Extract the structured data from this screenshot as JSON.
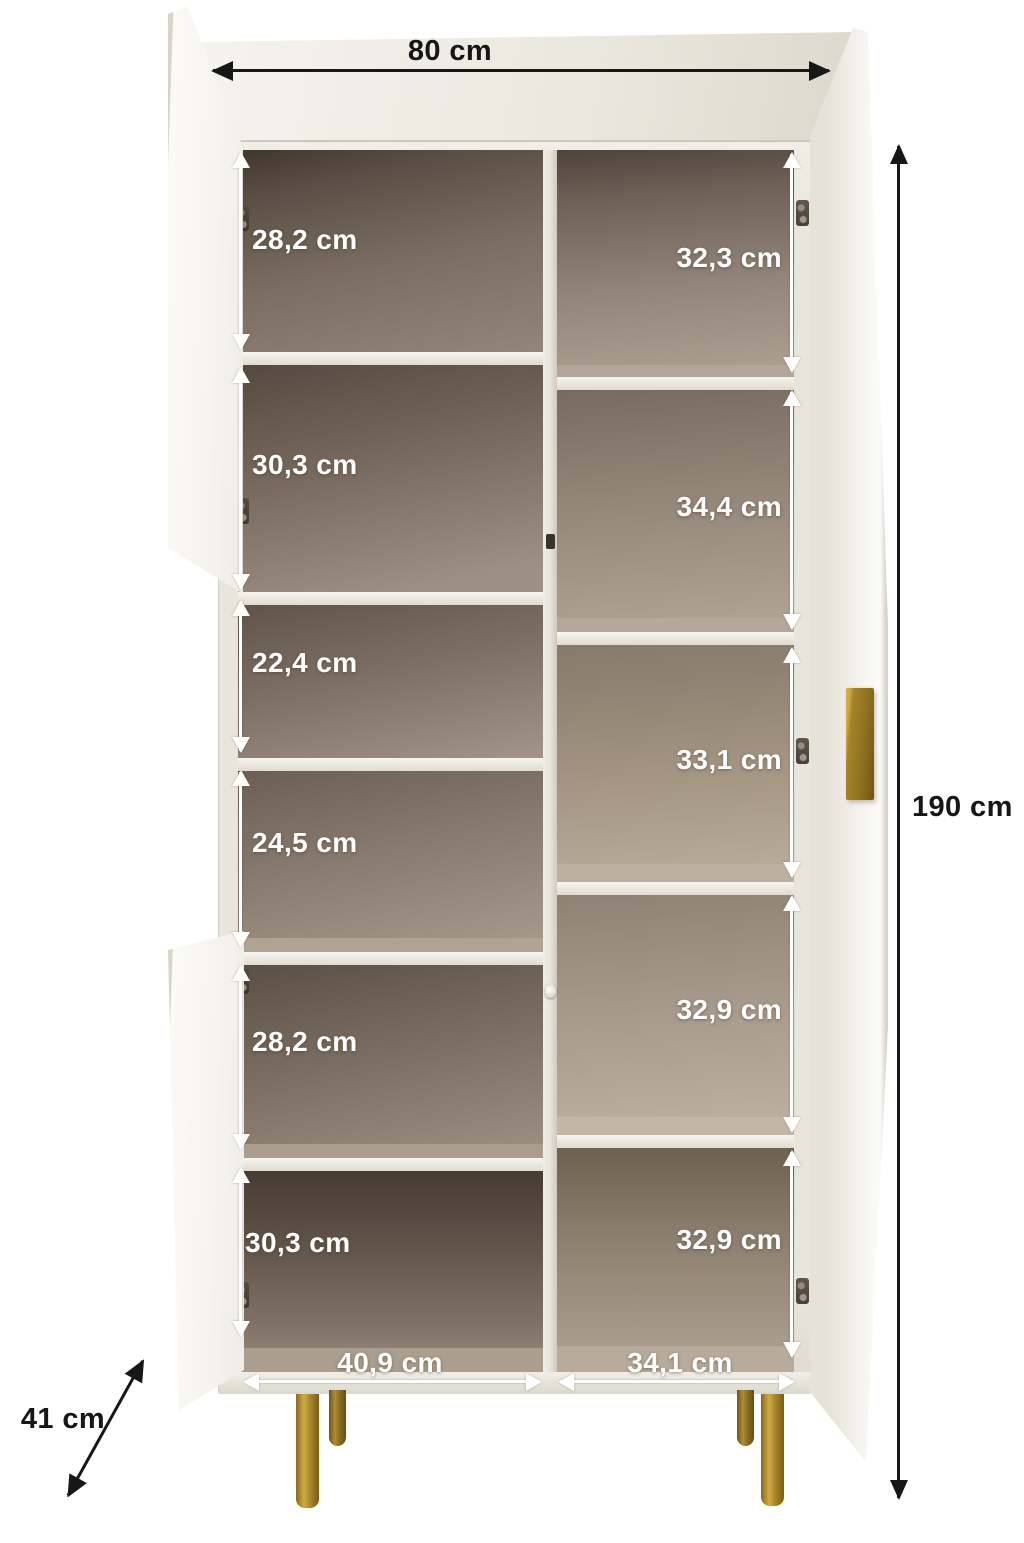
{
  "diagram": {
    "kind": "furniture-dimension-diagram",
    "subject": "open two-door display cabinet with shelves, gold handle and gold legs"
  },
  "dimensions": {
    "overall": {
      "width": "80 cm",
      "height": "190 cm",
      "depth": "41 cm"
    },
    "left_column": {
      "compartments": [
        "28,2 cm",
        "30,3 cm",
        "22,4 cm",
        "24,5 cm",
        "28,2 cm",
        "30,3 cm"
      ],
      "width": "40,9 cm"
    },
    "right_column": {
      "compartments": [
        "32,3 cm",
        "34,4 cm",
        "33,1 cm",
        "32,9 cm",
        "32,9 cm"
      ],
      "width": "34,1 cm"
    }
  },
  "colors": {
    "background": "#ffffff",
    "carcass": "#e8e5dc",
    "interior_taupe": "#9a8c80",
    "interior_dark": "#4e443b",
    "gold_accent": "#9c7c25",
    "dimension_dark": "#171717",
    "dimension_light": "#ffffff"
  }
}
